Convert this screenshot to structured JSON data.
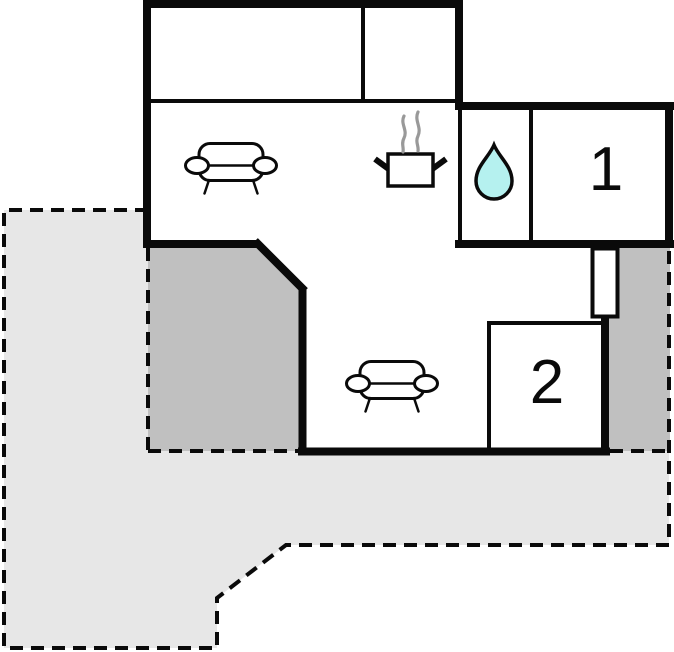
{
  "floor_plan": {
    "room_labels": {
      "bedroom_1": "1",
      "bedroom_2": "2"
    },
    "icons": [
      {
        "name": "sofa-icon"
      },
      {
        "name": "sofa-icon"
      },
      {
        "name": "cooking-pot-icon"
      },
      {
        "name": "water-drop-icon"
      }
    ],
    "colors": {
      "wall": "#0a0a0a",
      "room_fill": "#ffffff",
      "terrace_light": "#e7e7e7",
      "terrace_dark": "#c0c0c0",
      "water_drop_fill": "#b5f1ef",
      "steam": "#999999"
    }
  }
}
